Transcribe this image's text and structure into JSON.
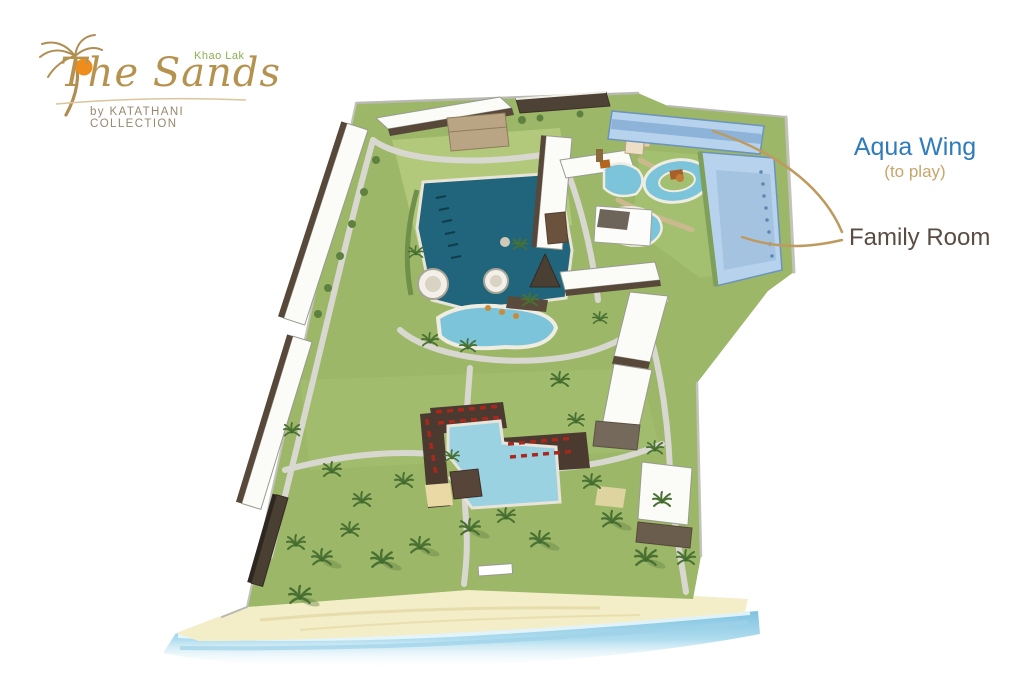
{
  "logo": {
    "region": "Khao Lak",
    "name": "The Sands",
    "byline": "by KATATHANI COLLECTION"
  },
  "annotations": {
    "aqua_wing": {
      "label": "Aqua Wing",
      "sublabel": "(to play)",
      "label_color": "#2e7bbd",
      "sublabel_color": "#c8a56b"
    },
    "family_room": {
      "label": "Family Room",
      "label_color": "#5a4c42"
    },
    "leader_line_color": "#bf9a5e"
  },
  "site_plan": {
    "features": [
      "guest-wing-buildings",
      "lagoon-pool",
      "round-pavilions",
      "free-form-pool",
      "family-pool-with-red-loungers",
      "aqua-park-pools",
      "lazy-river",
      "aqua-wing-building",
      "pathways",
      "palm-trees",
      "beach",
      "sea"
    ],
    "colors": {
      "lagoon": "#20657b",
      "pool_water": "#7cc4da",
      "lawn": "#9cb768",
      "aqua_wing_building": "#b7d2ec",
      "building_roof": "#fbfbf8",
      "building_face": "#57483a",
      "lounger_red": "#a8281e",
      "sand": "#f3edc8",
      "sea": "#8fcbe6"
    }
  }
}
